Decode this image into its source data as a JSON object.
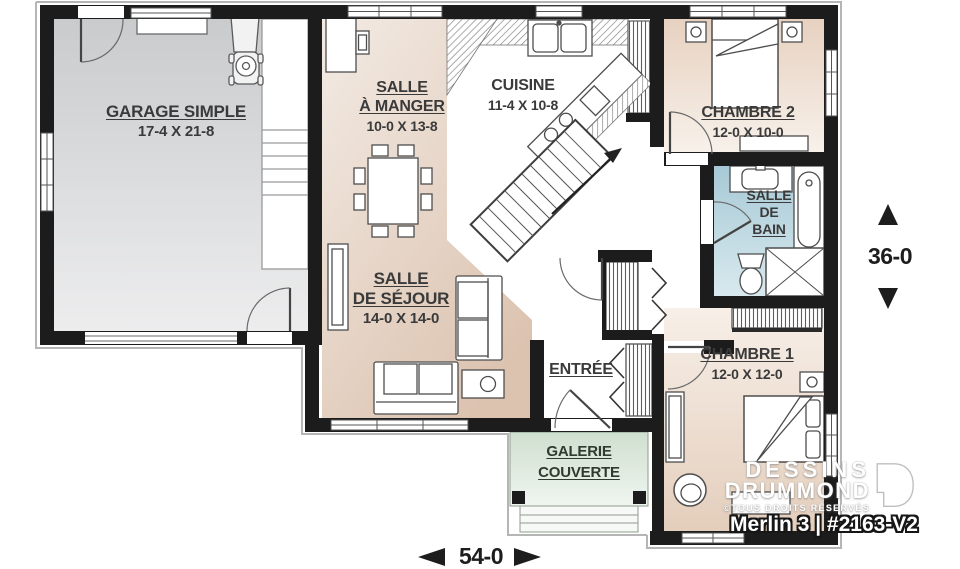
{
  "rooms": {
    "garage": {
      "name": "GARAGE SIMPLE",
      "dims": "17-4 X 21-8"
    },
    "dining": {
      "line1": "SALLE",
      "line2": "À MANGER",
      "dims": "10-0 X 13-8"
    },
    "kitchen": {
      "name": "CUISINE",
      "dims": "11-4 X 10-8"
    },
    "bedroom2": {
      "name": "CHAMBRE 2",
      "dims": "12-0 X 10-0"
    },
    "bathroom": {
      "line1": "SALLE",
      "line2": "DE",
      "line3": "BAIN"
    },
    "living": {
      "line1": "SALLE",
      "line2": "DE SÉJOUR",
      "dims": "14-0 X 14-0"
    },
    "entry": {
      "name": "ENTRÉE"
    },
    "bedroom1": {
      "name": "CHAMBRE 1",
      "dims": "12-0 X 12-0"
    },
    "porch": {
      "line1": "GALERIE",
      "line2": "COUVERTE"
    }
  },
  "dimensions": {
    "depth": "36-0",
    "width": "54-0"
  },
  "branding": {
    "brand_line1": "DESSINS",
    "brand_line2": "DRUMMOND",
    "copyright": "©TOUS DROITS RÉSERVÉS",
    "plan_title": "Merlin 3 | #2163-V2"
  },
  "colors": {
    "wall": "#1c1c1c",
    "floor_living": "#e2cbb9",
    "floor_garage": "#d2d4d6",
    "floor_bath": "#aecdd9",
    "floor_porch": "#d5e3d5",
    "label_text": "#3a3a3a"
  }
}
